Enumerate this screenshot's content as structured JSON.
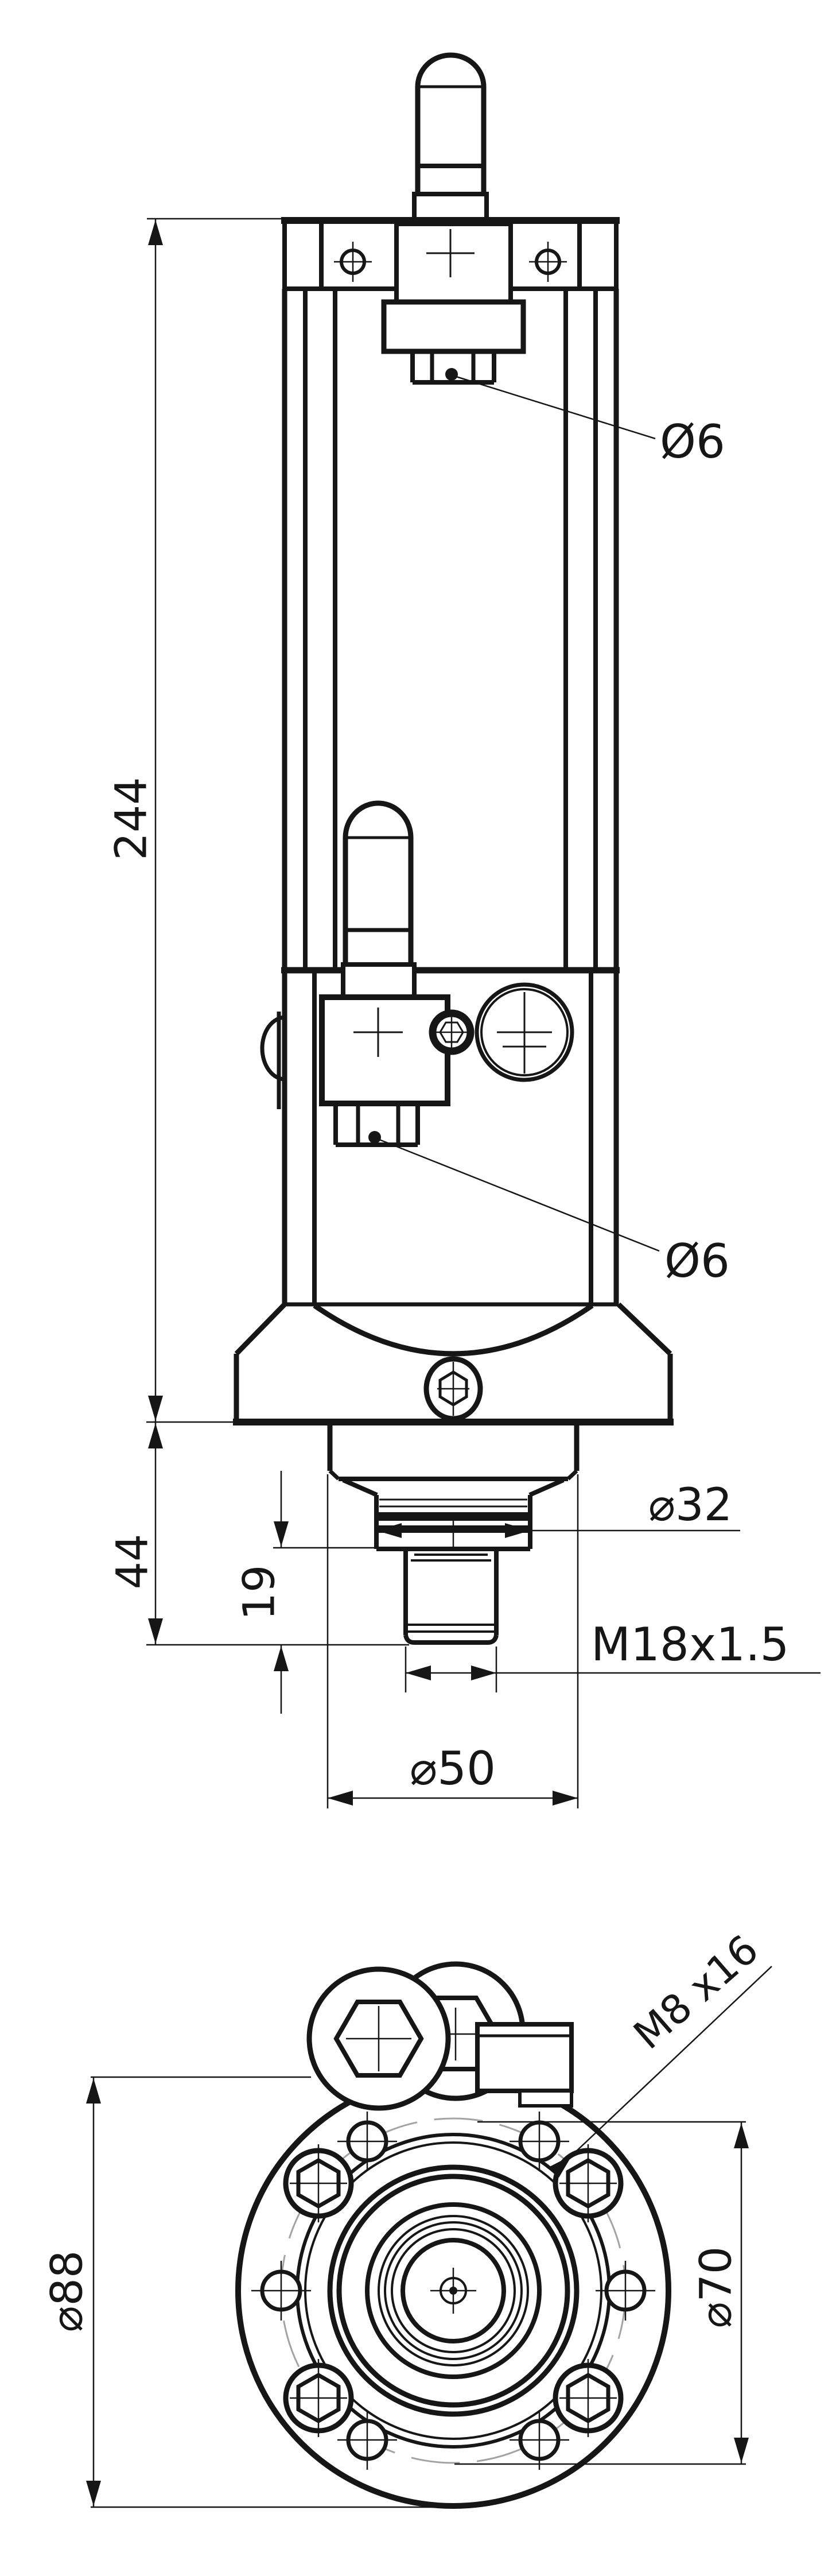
{
  "drawing": {
    "type": "technical-drawing",
    "views": [
      "front-elevation",
      "bottom-view"
    ],
    "colors": {
      "line": "#161616",
      "background": "#ffffff",
      "bolt_circle": "#a3a3a3"
    },
    "labels": {
      "overall_height": "244",
      "flange_to_tip": "44",
      "thread_length": "19",
      "vent_hole_top": "Ø6",
      "vent_hole_mid": "Ø6",
      "neck_diameter": "⌀32",
      "thread_spec": "M18x1.5",
      "collar_diameter": "⌀50",
      "bolt_spec": "M8 x16",
      "flange_diameter": "⌀88",
      "bolt_circle_diameter": "⌀70"
    }
  }
}
